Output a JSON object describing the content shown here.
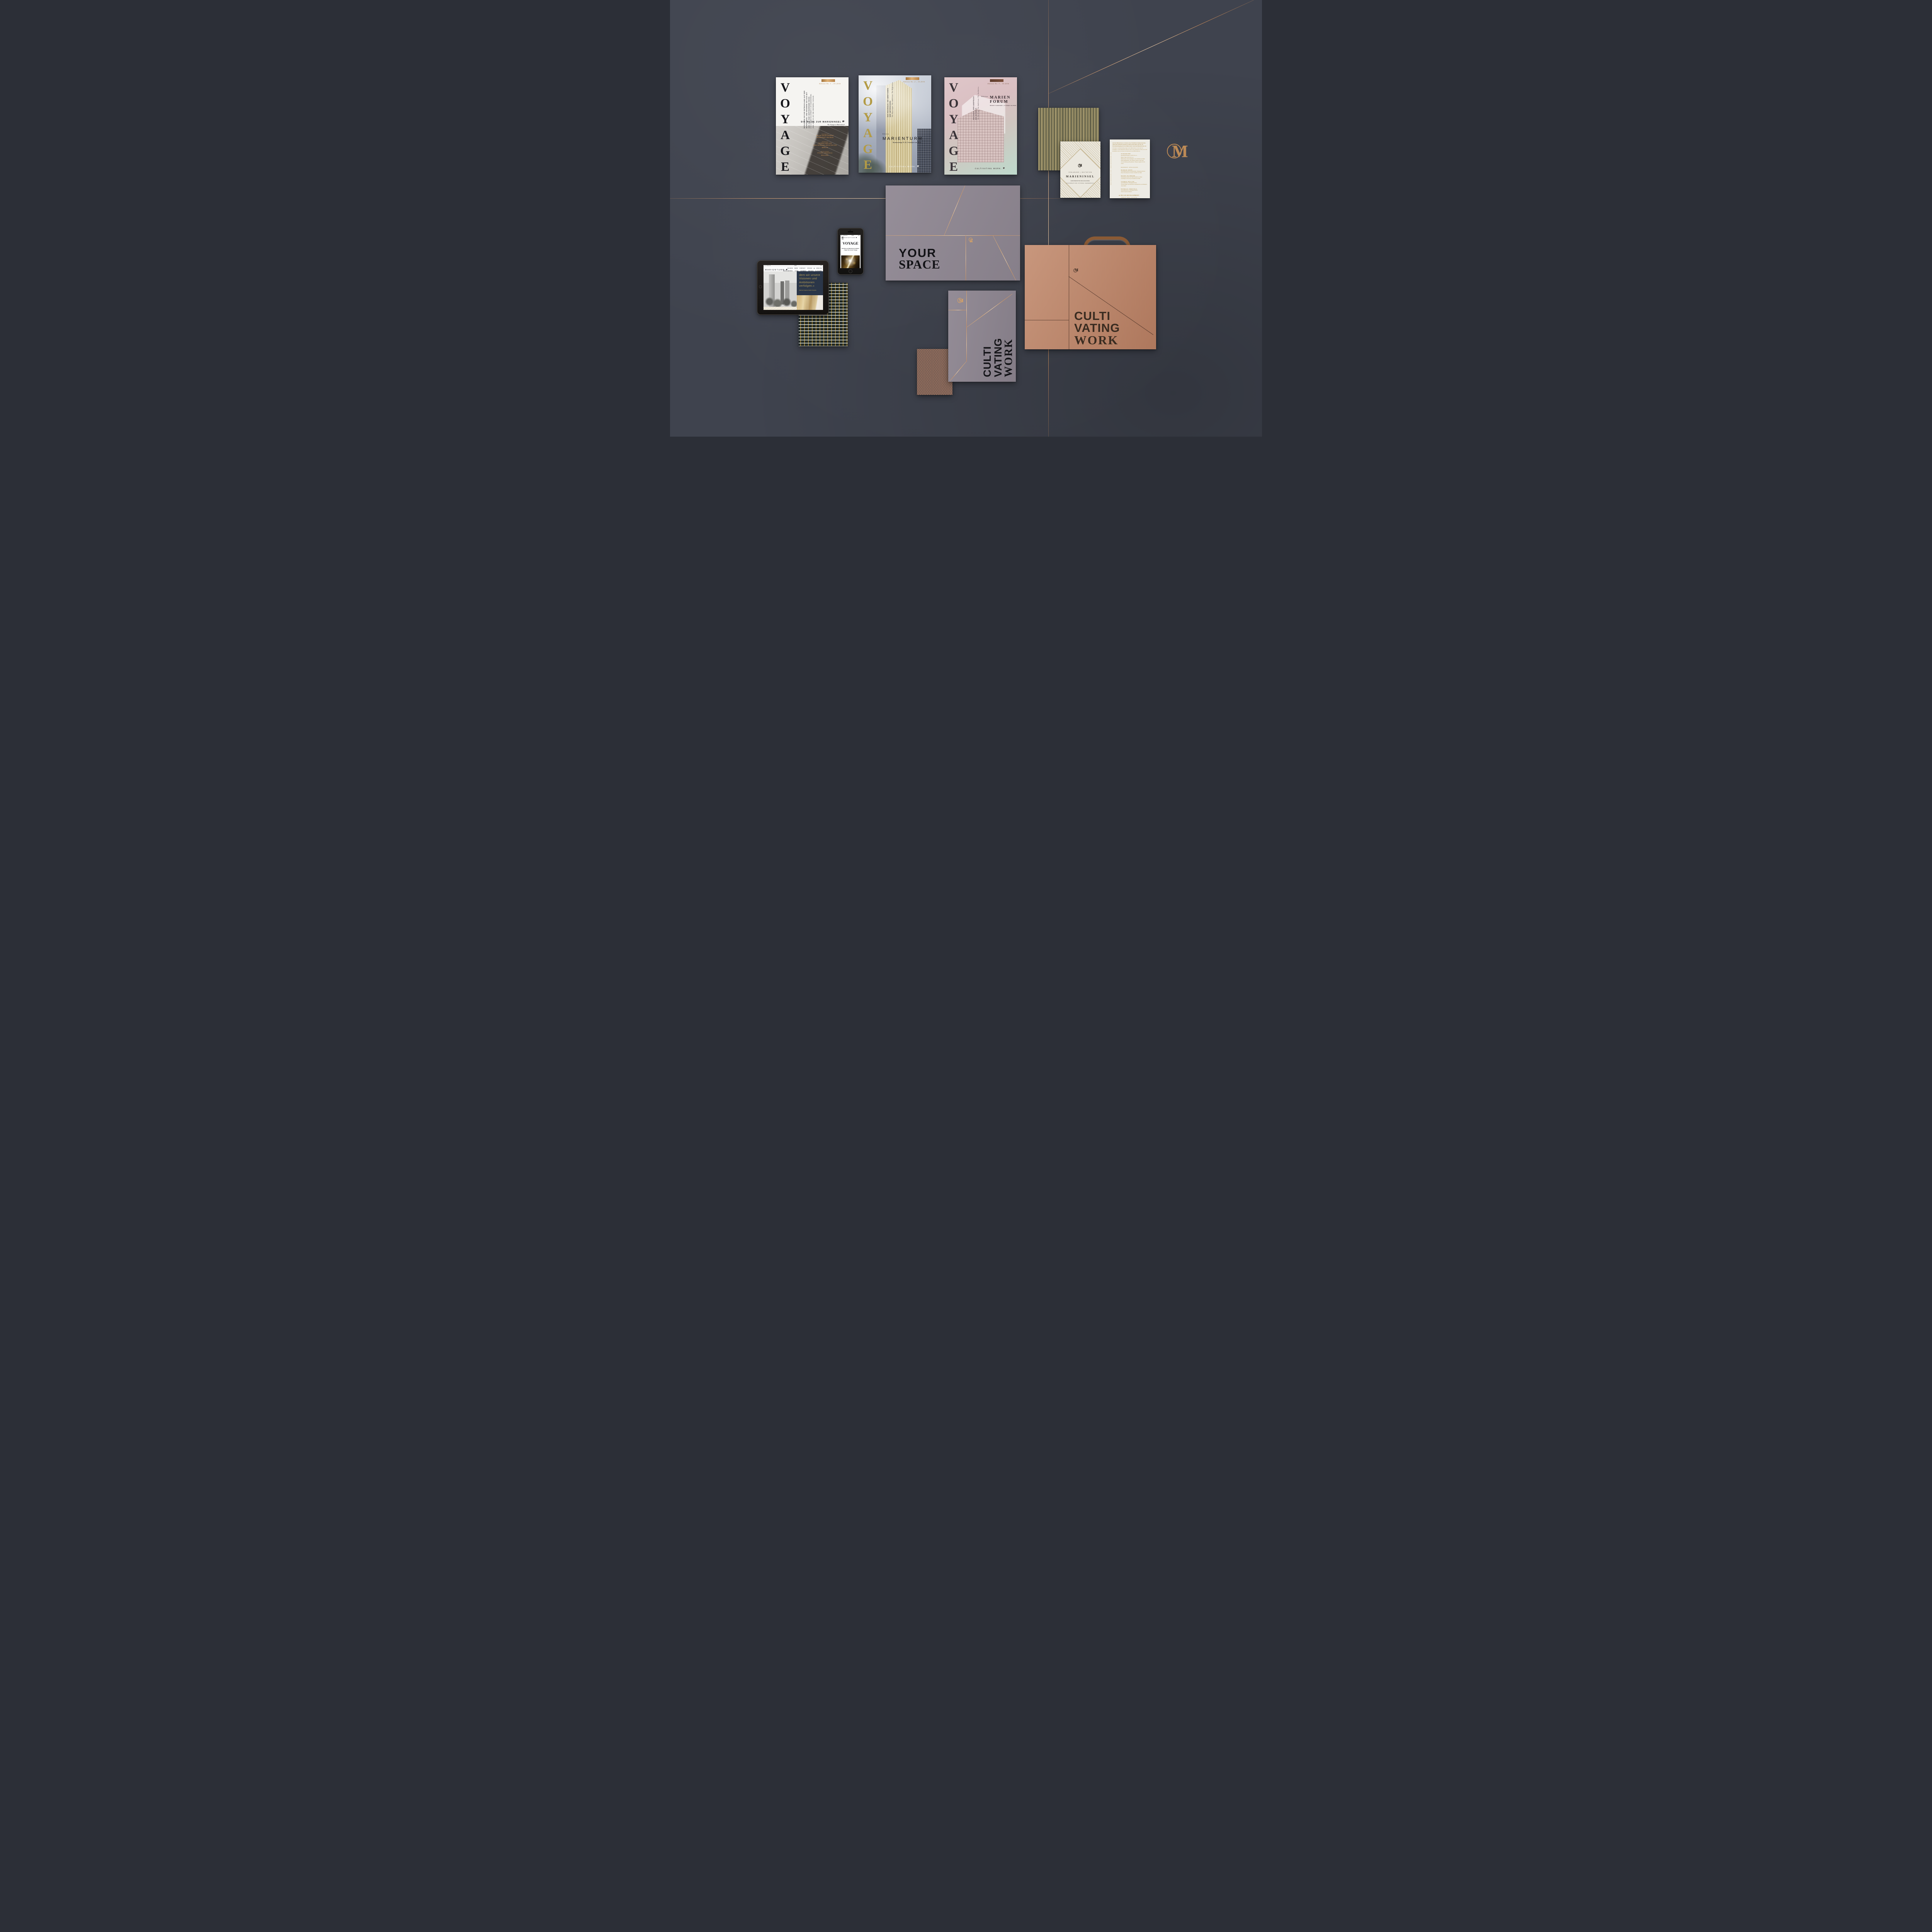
{
  "colors": {
    "wall": "#3f434e",
    "copper_foil": "#d9a071",
    "gold_text": "#b3924f",
    "mauve_paper": "#8e8691",
    "copper_box": "#bd8366",
    "navy_panel": "#2b3648"
  },
  "magazines": [
    {
      "title": "VOYAGE",
      "edition": "Edition No. 1 – 01.2016",
      "tagline_de_1": "BEGLEITEN SIE DIE ENTWICKLUNG AUF DER",
      "tagline_de_2": "MARIENINSEL UND BEGEBEN SIE SICH MIT",
      "tagline_de_3": "UNS AUF EINE INSPIRIERENDE REISE.",
      "tagline_en_1": "FOLLOW DEVELOPMENTS ON MARIENINSEL",
      "tagline_en_2": "AND JOIN US ON THE INSPIRING VOYAGE.",
      "heading": "DIE REISE ZUR MARIENINSEL",
      "subheading": "The Voyage to Marieninsel",
      "credits": [
        {
          "label": "Development",
          "line1": "PECAN DEVELOPMENT",
          "line2": "FRANKFURT AM MAIN",
          "line3": ""
        },
        {
          "label": "Architecture",
          "line1": "THOMAS MÜLLER",
          "line2": "IVAN REIMANN ARCHITEKTEN",
          "line3": "BERLIN"
        },
        {
          "label": "Interior Design",
          "line1": "STUDIO URQUIOLA",
          "line2": "MAILAND",
          "line3": ""
        }
      ]
    },
    {
      "title": "VOYAGE",
      "edition": "Edition No. 2 – 10.2016",
      "tagline_de_1": "DAS HOCHHAUS. DIE AMBITIONEN.",
      "tagline_de_2": "DER UNTERSCHIED.",
      "tagline_en": "The Skyscraper. The Ambitions. The Difference.",
      "edition_label": "Edition",
      "project": "MARIENTURM",
      "address": "Taunusanlage 9–10, Frankfurt am Main",
      "footer": "CULTIVATING WORK."
    },
    {
      "title": "VOYAGE",
      "edition": "Edition No. 3 – 10.2016",
      "tagline_de_1": "DAS HAUS. DER ANSPRUCH.",
      "tagline_de_2": "DIE ÄSTHETIK.",
      "tagline_en": "The Building. The Ambitions. The Aesthetics.",
      "edition_label": "Edition",
      "project_line1": "MARIEN",
      "project_line2": "FORUM",
      "address": "Mainzer Landstraße 1, Frankfurt am Main",
      "footer": "CULTIVATING WORK."
    }
  ],
  "invitation_front": {
    "line1": "EINLADUNG | INVITATION",
    "title": "MARIENINSEL",
    "line2": "GRUNDSTEINLEGUNG",
    "line3": "FOUNDATION STONE CEREMONY"
  },
  "invitation_back": {
    "intro_de": "Auf der Marieninsel, im Herzen des Frankfurter Bankenviertels, nimmt die Zukunft Gestalt an. Mit Freude laden wir Sie zur Grundsteinlegung für den Marienturm und das Marienforum ein. ",
    "intro_en": "The future is already taking shape at the Marieninsel, at the heart of Frankfurt's Central Business District. We are very pleased to invite you to the foundation stone ceremony for Marienturm and Marienforum.",
    "event_1": "10. November 2016",
    "event_2": "Empfang Reception 10.00 Uhr a.m.",
    "event_3": "Beginn Start 10.30 Uhr a.m.",
    "event_4": "Marieninsel, Taunusanlage 9–10, Frankfurt am Main",
    "event_5": "Parkmöglichkeiten Car parking Trianon, Alte Oper",
    "event_6": "Um Anmeldung wird gebeten. Please register for the event.",
    "speakers_heading": "REDNER SPEAKERS",
    "speakers": [
      {
        "name": "MARKUS BROD",
        "role": "Geschäftsführender Gesellschafter | Managing Partner",
        "org": "Pecan Development GmbH, Frankfurt am Main"
      },
      {
        "name": "PETER FELDMANN",
        "role": "Oberbürgermeister der Stadt Frankfurt am Main",
        "org": "Lord Mayor of the City of Frankfurt am Main"
      },
      {
        "name": "THOMAS MÜLLER",
        "role": "Geschäftsführer | Managing Partner",
        "org": "Thomas Müller Ivan Reimann Gesellschaft von Architekten mbH, Berlin"
      },
      {
        "name": "PATRICIA URQUIOLA",
        "role": "Geschäftsführerin | Managing Partner",
        "org": "Studio Urquiola, Mailand"
      }
    ],
    "websites": "www.marienturm.com | www.marienforum.com",
    "brand": "PECAN DEVELOPMENT",
    "brand_tagline": "URBAN REAL ESTATE SOLUTIONS."
  },
  "wall_logo": {
    "letter": "M"
  },
  "folder_your_space": {
    "line1": "YOUR",
    "line2": "SPACE"
  },
  "folder_cultivating": {
    "line1": "CULTI",
    "line2": "VATING",
    "line3": "WORK"
  },
  "presentation_box": {
    "line1": "CULTI",
    "line2": "VATING",
    "line3": "WORK"
  },
  "iphone": {
    "signal": "●●●○○",
    "carrier": "Telekom.de",
    "time": "12:30",
    "battery": "100%",
    "brand": "MARIENTURM",
    "title": "VOYAGE",
    "subtitle": "Die Reise zur Marieninsel in Bildern – folgen Sie unserer Voyage."
  },
  "ipad": {
    "signal": "●●●○○",
    "carrier": "Telekom.de",
    "time": "12:30",
    "battery": "100%",
    "brand": "MARIENTURM",
    "nav_top": [
      "GALERIE",
      "NEWS",
      "KONTAKT",
      "VOYAGE",
      "ENGLISH"
    ],
    "nav_main": [
      "MARIENINSEL",
      "LAGE",
      "COSMOS",
      "DESIGN",
      "FLÄCHEN"
    ],
    "quote": "dem wir unsere Visionen und Ambitionen verfolgen.«",
    "attribution": "Patricia Urquiola, Studio Urquiola"
  }
}
